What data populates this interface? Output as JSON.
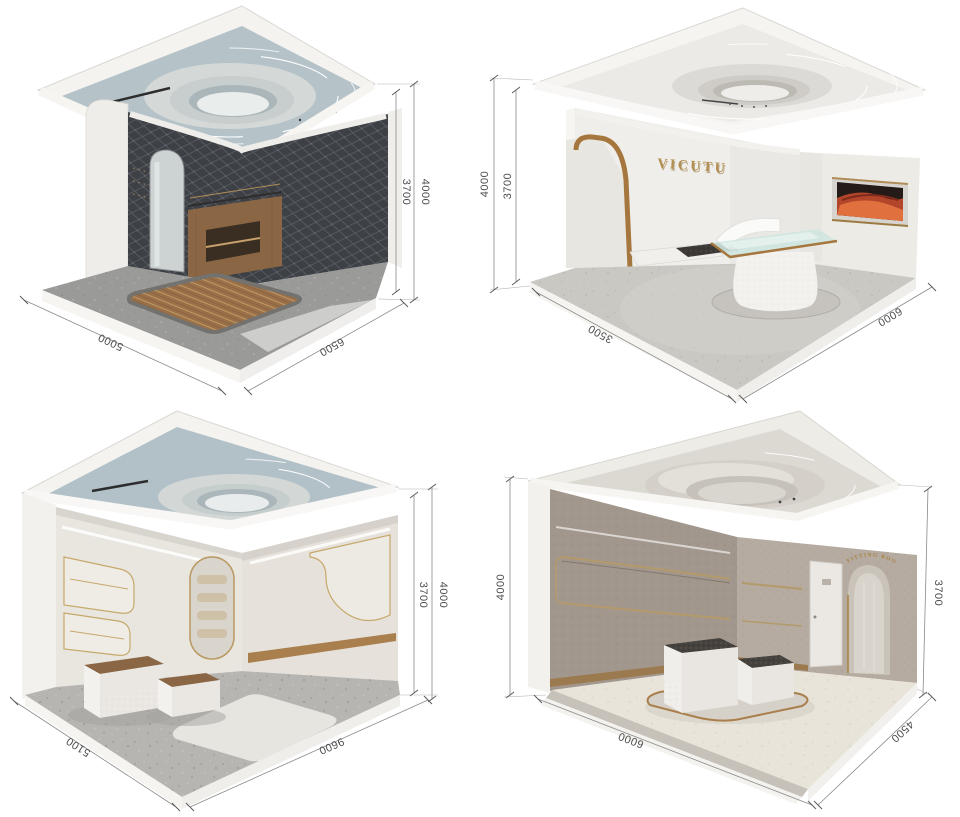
{
  "texts": {
    "brand_logo": "VICUTU",
    "fitting_room_sign": "FITTING ROOM"
  },
  "colors": {
    "brand_gold": "#b28e4e",
    "trim_gold": "#a5773f",
    "ceiling_blue_gray": "#b5c3c9",
    "quilt_charcoal": "#3d4045",
    "walnut_wood": "#8a6644",
    "terrazzo_gray": "#9b9b99",
    "suede_taupe": "#a2978c",
    "artwork_orange": "#c4502e",
    "dimension_line_gray": "#888888"
  },
  "rooms": [
    {
      "position": "top-left",
      "dims": {
        "height_outer": "4000",
        "height_inner": "3700",
        "floor_left": "5000",
        "floor_right": "6500"
      }
    },
    {
      "position": "top-right",
      "dims": {
        "height_outer": "4000",
        "height_inner": "3700",
        "floor_left": "3500",
        "floor_right": "6000"
      }
    },
    {
      "position": "bottom-left",
      "dims": {
        "height_outer": "4000",
        "height_inner": "3700",
        "floor_left": "5100",
        "floor_right": "9600"
      }
    },
    {
      "position": "bottom-right",
      "dims": {
        "height_outer": "4000",
        "height_inner": "3700",
        "floor_left": "6000",
        "floor_right": "4500"
      }
    }
  ]
}
